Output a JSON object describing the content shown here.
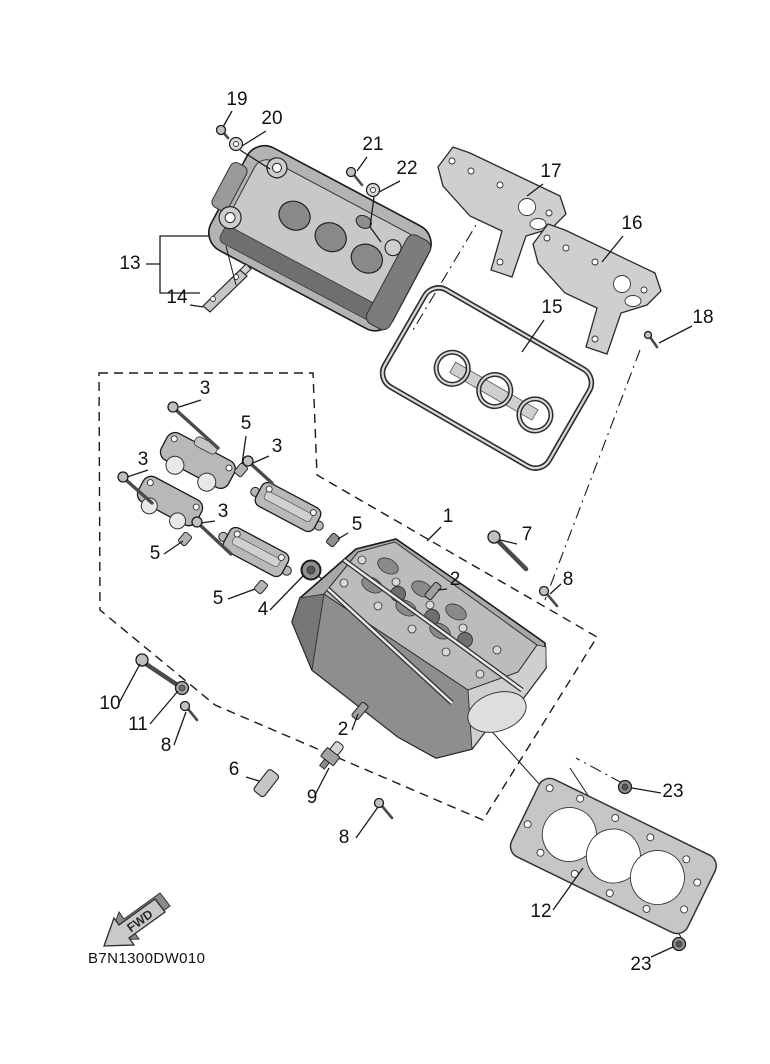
{
  "diagram": {
    "code": "B7N1300DW010",
    "fwd": "FWD"
  },
  "callouts": [
    {
      "label": "19"
    },
    {
      "label": "20"
    },
    {
      "label": "21"
    },
    {
      "label": "22"
    },
    {
      "label": "17"
    },
    {
      "label": "16"
    },
    {
      "label": "18"
    },
    {
      "label": "15"
    },
    {
      "label": "13"
    },
    {
      "label": "14"
    },
    {
      "label": "3"
    },
    {
      "label": "5"
    },
    {
      "label": "3"
    },
    {
      "label": "3"
    },
    {
      "label": "3"
    },
    {
      "label": "5"
    },
    {
      "label": "5"
    },
    {
      "label": "5"
    },
    {
      "label": "4"
    },
    {
      "label": "1"
    },
    {
      "label": "7"
    },
    {
      "label": "2"
    },
    {
      "label": "8"
    },
    {
      "label": "10"
    },
    {
      "label": "11"
    },
    {
      "label": "8"
    },
    {
      "label": "2"
    },
    {
      "label": "6"
    },
    {
      "label": "9"
    },
    {
      "label": "8"
    },
    {
      "label": "12"
    },
    {
      "label": "23"
    },
    {
      "label": "23"
    }
  ]
}
